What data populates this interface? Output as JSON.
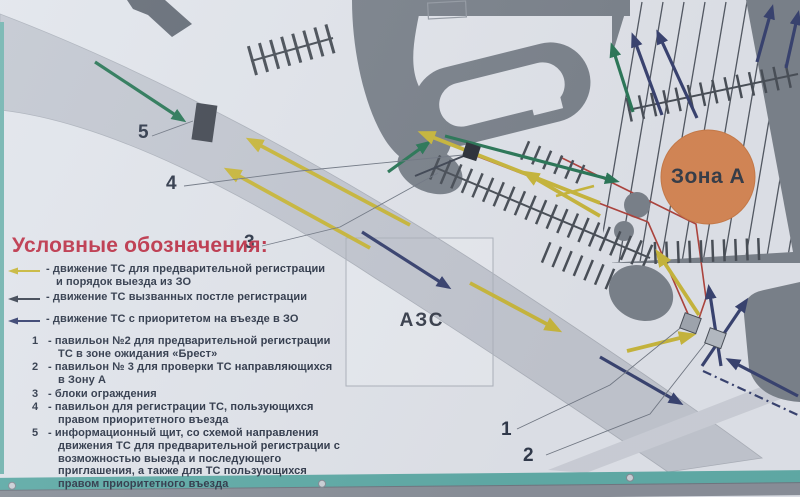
{
  "colors": {
    "photo_bg": "#8e959d",
    "sign_bg": "#e8ebf0",
    "road": "#c9cdd5",
    "road_edge": "#b2b7bf",
    "band2": "#d3d7de",
    "building": "#80878f",
    "building_dark": "#6a717a",
    "comb": "#4d535a",
    "stripe": "#565c65",
    "yellow": "#cfbd3e",
    "green": "#2e7c5a",
    "navy": "#3c4673",
    "dark": "#434a56",
    "red": "#b5473f",
    "orange": "#dd8c58",
    "orange_edge": "#cf7f4a",
    "teal": "#64b1ab",
    "teal_side": "#79bab4",
    "metal": "#8f959d",
    "bolt": "#d3d8dd",
    "legend_title": "#c43a4e",
    "text_dark": "#333c4c",
    "callout": "#767d88",
    "pav1": "#a7adb5",
    "pav2": "#bcc2c9",
    "board": "#494e56",
    "black_sq": "#2e333a",
    "azs_fill": "#eef1f5",
    "azs_stroke": "#b3b8c0"
  },
  "map": {
    "zone_a_label": "Зона А",
    "azs_label": "АЗС",
    "callout_numbers": {
      "n1": "1",
      "n2": "2",
      "n3": "3",
      "n4": "4",
      "n5": "5"
    }
  },
  "legend": {
    "title": "Условные обозначения:",
    "arrow_items": [
      {
        "icon": "yellow-arrow-icon",
        "lines": [
          "- движение ТС для предварительной регистрации",
          "и порядок выезда из ЗО"
        ]
      },
      {
        "icon": "dark-arrow-icon",
        "lines": [
          "- движение ТС вызванных постле регистрации"
        ]
      },
      {
        "icon": "navy-arrow-icon",
        "lines": [
          "- движение ТС с приоритетом на въезде в ЗО"
        ]
      }
    ],
    "numbered_items": [
      {
        "num": "1",
        "lines": [
          "- павильон №2 для предварительной регистрации",
          "ТС в зоне ожидания «Брест»"
        ]
      },
      {
        "num": "2",
        "lines": [
          "- павильон № 3  для проверки ТС направляющихся",
          "в Зону А"
        ]
      },
      {
        "num": "3",
        "lines": [
          "- блоки ограждения"
        ]
      },
      {
        "num": "4",
        "lines": [
          "- павильон для регистрации ТС, пользующихся",
          "правом приоритетного въезда"
        ]
      },
      {
        "num": "5",
        "lines": [
          "- информационный щит, со схемой направления",
          "движения ТС для предварительной регистрации с",
          "возможностью выезда и последующего",
          "приглашения, а также для ТС пользующихся",
          "правом приоритетного въезда"
        ]
      }
    ]
  }
}
